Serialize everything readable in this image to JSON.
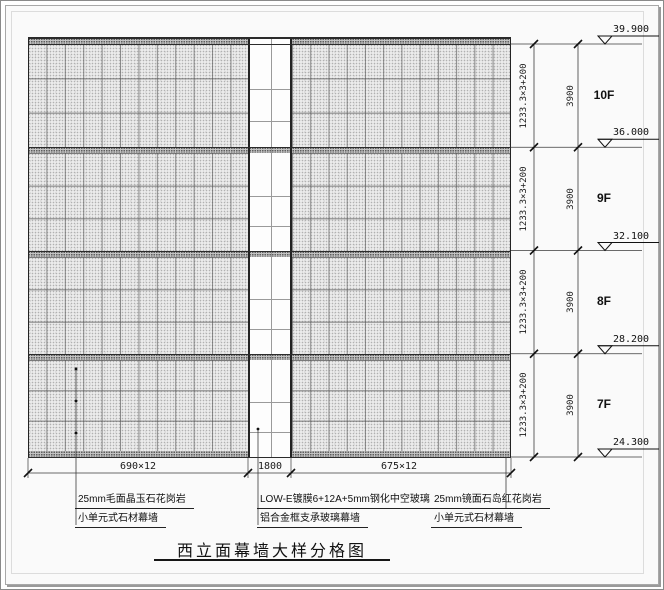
{
  "title": "西立面幕墙大样分格图",
  "floors": [
    {
      "label": "10F",
      "elevation": "39.900",
      "panel_dim": "1233.3×3+200",
      "floor_height": "3900"
    },
    {
      "label": "9F",
      "elevation": "36.000",
      "panel_dim": "1233.3×3+200",
      "floor_height": "3900"
    },
    {
      "label": "8F",
      "elevation": "32.100",
      "panel_dim": "1233.3×3+200",
      "floor_height": "3900"
    },
    {
      "label": "7F",
      "elevation": "28.200",
      "panel_dim": "1233.3×3+200",
      "floor_height": "3900"
    }
  ],
  "base_elevation": "24.300",
  "bottom_dimensions": {
    "left_stone": "690×12",
    "glass": "1800",
    "right_stone": "675×12"
  },
  "annotations": {
    "left": [
      "25mm毛面晶玉石花岗岩",
      "小单元式石材幕墙"
    ],
    "center": [
      "LOW-E镀膜6+12A+5mm钢化中空玻璃",
      "铝合金框支承玻璃幕墙"
    ],
    "right": [
      "25mm镜面石岛红花岗岩",
      "小单元式石材幕墙"
    ]
  },
  "colors": {
    "line": "#2b2b2b",
    "dim_line": "#3a3a3a",
    "stone_fill": "#ebebeb",
    "band_fill": "#c2c2c2",
    "glass_fill": "#fdfdfd"
  }
}
